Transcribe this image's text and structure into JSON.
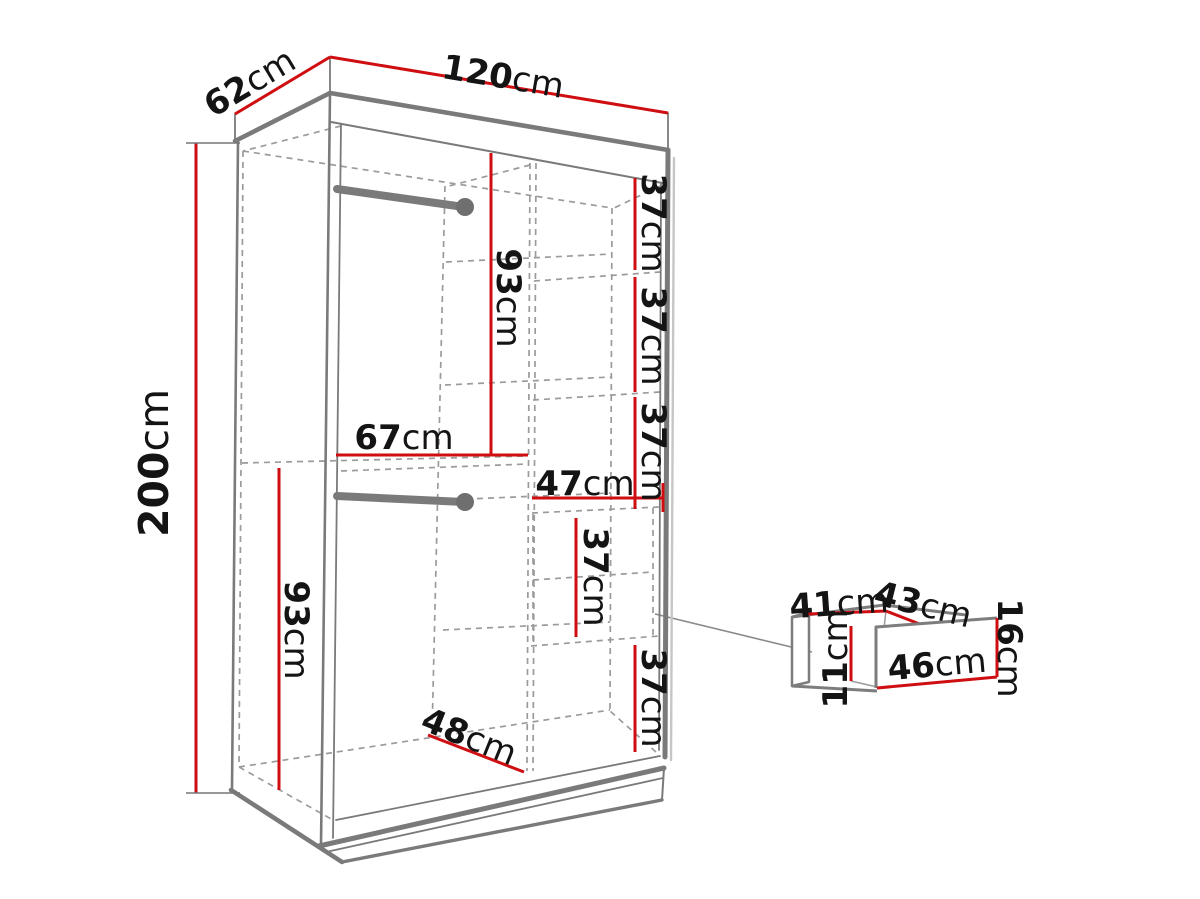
{
  "diagram": {
    "kind": "wardrobe-dimension-diagram",
    "unit": "cm"
  },
  "colors": {
    "dimension_red": "#cf0e12",
    "structure_gray": "#7a7a7a",
    "hidden_dash_gray": "#9b9b9b",
    "label_black": "#141414",
    "background": "#ffffff"
  },
  "labels": {
    "depth": {
      "num": "62",
      "unit": "cm"
    },
    "width": {
      "num": "120",
      "unit": "cm"
    },
    "height": {
      "num": "200",
      "unit": "cm"
    },
    "upper_section_height": {
      "num": "93",
      "unit": "cm"
    },
    "left_width": {
      "num": "67",
      "unit": "cm"
    },
    "right_width": {
      "num": "47",
      "unit": "cm"
    },
    "shelf_gap_1": {
      "num": "37",
      "unit": "cm"
    },
    "shelf_gap_2": {
      "num": "37",
      "unit": "cm"
    },
    "shelf_gap_3": {
      "num": "37",
      "unit": "cm"
    },
    "drawer_bay": {
      "num": "37",
      "unit": "cm"
    },
    "bottom_space": {
      "num": "37",
      "unit": "cm"
    },
    "lower_section_height": {
      "num": "93",
      "unit": "cm"
    },
    "interior_depth": {
      "num": "48",
      "unit": "cm"
    },
    "drawer_top_width": {
      "num": "41",
      "unit": "cm"
    },
    "drawer_top_depth": {
      "num": "43",
      "unit": "cm"
    },
    "drawer_inner_height": {
      "num": "11",
      "unit": "cm"
    },
    "drawer_front_width": {
      "num": "46",
      "unit": "cm"
    },
    "drawer_front_height": {
      "num": "16",
      "unit": "cm"
    }
  }
}
